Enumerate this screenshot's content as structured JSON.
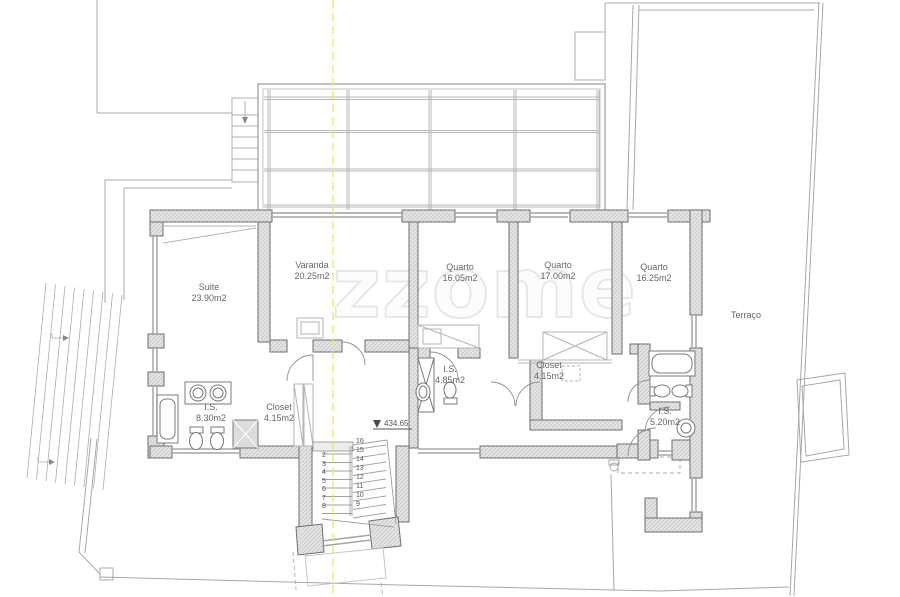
{
  "watermark": {
    "text": "zzome"
  },
  "labels": {
    "terrace": "Terraço",
    "elevation": "434.65"
  },
  "rooms": [
    {
      "name": "Suite",
      "area": "23.90m2"
    },
    {
      "name": "Varanda",
      "area": "20.25m2"
    },
    {
      "name": "Quarto",
      "area": "16.05m2"
    },
    {
      "name": "Quarto",
      "area": "17.00m2"
    },
    {
      "name": "Quarto",
      "area": "16.25m2"
    },
    {
      "name": "I.S.",
      "area": "4.85m2"
    },
    {
      "name": "Closet",
      "area": "4.15m2"
    },
    {
      "name": "I.S.",
      "area": "8.30m2"
    },
    {
      "name": "Closet",
      "area": "4.15m2"
    },
    {
      "name": "I.S.",
      "area": "5.20m2"
    }
  ],
  "stairs": {
    "left": [
      "2",
      "3",
      "4",
      "5",
      "6",
      "7",
      "8"
    ],
    "right": [
      "16",
      "15",
      "14",
      "13",
      "12",
      "11",
      "10",
      "9"
    ]
  },
  "colors": {
    "wall_fill": "#e3e3e3",
    "wall_stroke": "#6e6e6e",
    "thin_line": "#b5b5b5",
    "axis_yellow": "#eaea45",
    "text": "#666666",
    "watermark": "#e7e7e7"
  }
}
